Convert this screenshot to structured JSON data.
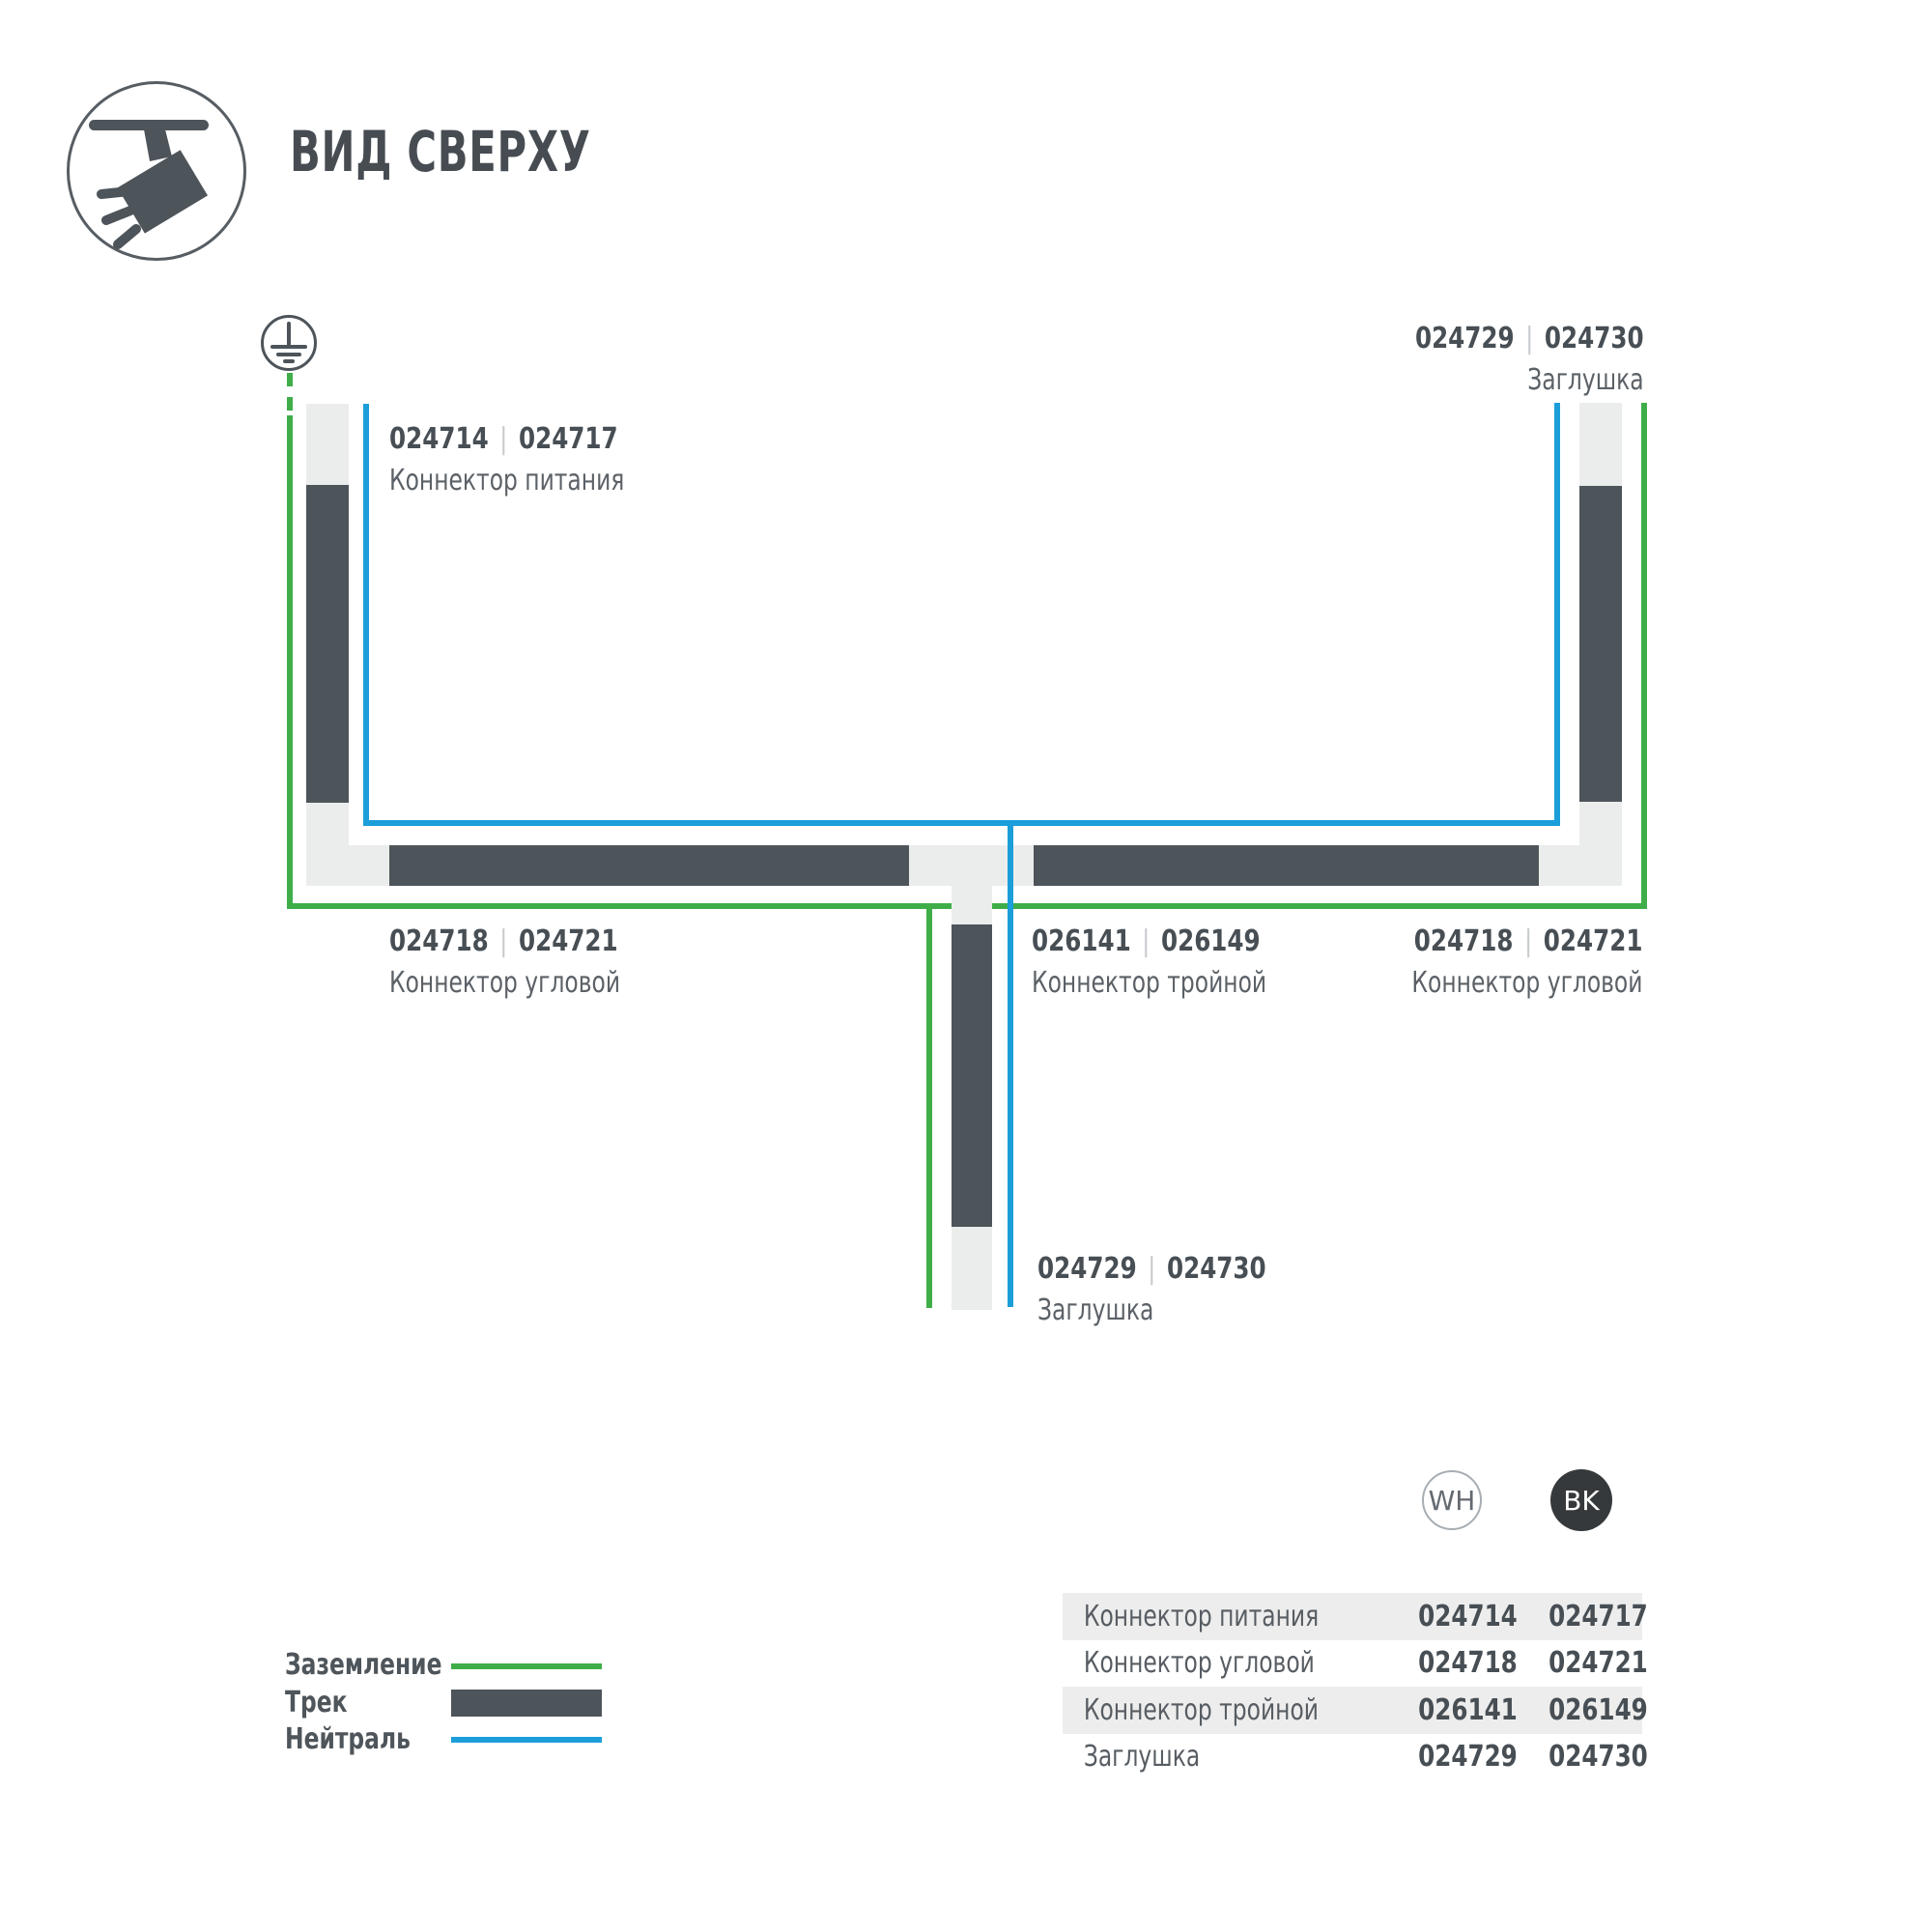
{
  "header": {
    "title": "ВИД СВЕРХУ"
  },
  "diagram": {
    "separator": "|",
    "labels": {
      "power_connector": {
        "code_wh": "024714",
        "code_bk": "024717",
        "name": "Коннектор питания"
      },
      "end_cap_top": {
        "code_wh": "024729",
        "code_bk": "024730",
        "name": "Заглушка"
      },
      "corner_connector_left": {
        "code_wh": "024718",
        "code_bk": "024721",
        "name": "Коннектор угловой"
      },
      "triple_connector": {
        "code_wh": "026141",
        "code_bk": "026149",
        "name": "Коннектор тройной"
      },
      "corner_connector_right": {
        "code_wh": "024718",
        "code_bk": "024721",
        "name": "Коннектор угловой"
      },
      "end_cap_bottom": {
        "code_wh": "024729",
        "code_bk": "024730",
        "name": "Заглушка"
      }
    }
  },
  "legend": {
    "items": [
      {
        "label": "Заземление",
        "swatch": "ground-line",
        "color": "#3fae49"
      },
      {
        "label": "Трек",
        "swatch": "track-bar",
        "color": "#4d545a"
      },
      {
        "label": "Нейтраль",
        "swatch": "neutral-line",
        "color": "#1b9ed9"
      }
    ]
  },
  "variants": {
    "white": "WH",
    "black": "BK"
  },
  "table": {
    "rows": [
      {
        "name": "Коннектор питания",
        "wh": "024714",
        "bk": "024717"
      },
      {
        "name": "Коннектор угловой",
        "wh": "024718",
        "bk": "024721"
      },
      {
        "name": "Коннектор тройной",
        "wh": "026141",
        "bk": "026149"
      },
      {
        "name": "Заглушка",
        "wh": "024729",
        "bk": "024730"
      }
    ]
  },
  "colors": {
    "ground_green": "#3fae49",
    "neutral_blue": "#1b9ed9",
    "track_dark": "#4d545a",
    "track_light": "#ebedec"
  }
}
